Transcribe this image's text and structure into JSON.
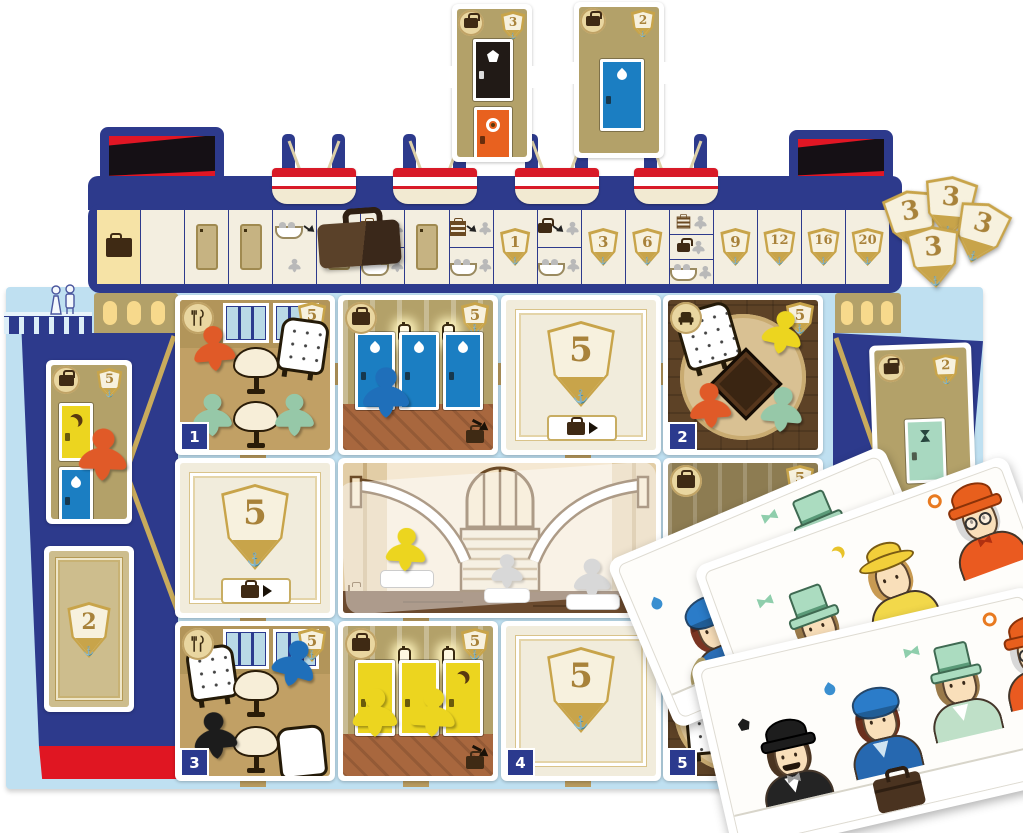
{
  "top_corridor_tiles": [
    {
      "shield": "3",
      "doors": [
        "black-pentagon",
        "orange-ring"
      ]
    },
    {
      "shield": "2",
      "doors": [
        "blue-drop"
      ]
    }
  ],
  "score_track": {
    "shields": [
      "1",
      "3",
      "6",
      "9",
      "12",
      "16",
      "20"
    ],
    "squares": [
      "start-suitcase",
      "blank",
      "door",
      "door",
      "boat-meeple",
      "door-with-suitcase-piece",
      "split-stack-boat",
      "door",
      "split-stack-boat",
      "shield-1",
      "split-suitcase-boat",
      "shield-3",
      "shield-6",
      "split-stack-suitcase-boat",
      "shield-9",
      "shield-12",
      "shield-16",
      "shield-20"
    ]
  },
  "victory_tokens": {
    "value": "3",
    "count": 4
  },
  "side_tiles": {
    "left_cabin_shield": "5",
    "left_score_value": "2",
    "right_cabin_shield": "2"
  },
  "grid_tiles": {
    "dining1": {
      "badge": "1",
      "shield": "5"
    },
    "cabin_blue": {
      "shield": "5"
    },
    "score_a": {
      "value": "5"
    },
    "lounge2": {
      "badge": "2",
      "shield": "5"
    },
    "score_b": {
      "value": "5"
    },
    "cabin_dark": {
      "shield": "5"
    },
    "dining3": {
      "badge": "3",
      "shield": "5"
    },
    "cabin_yellow": {
      "shield": "5"
    },
    "score_c": {
      "value": "5",
      "badge": "4"
    },
    "lounge5": {
      "badge": "5"
    }
  },
  "cards": [
    {
      "characters": [
        {
          "hat": "blue-cloche",
          "icon": "drop"
        },
        {
          "hat": "green-tophat",
          "icon": "bow"
        }
      ],
      "extra": "turn-arrow"
    },
    {
      "characters": [
        {
          "hat": "green-tophat",
          "icon": "bow"
        },
        {
          "hat": "yellow-sun",
          "icon": "moon"
        },
        {
          "hat": "orange-bowler",
          "icon": "ring"
        }
      ]
    },
    {
      "characters": [
        {
          "hat": "black-bowler",
          "icon": "pentagon"
        },
        {
          "hat": "blue-cloche",
          "icon": "drop"
        },
        {
          "hat": "green-tophat",
          "icon": "bow"
        },
        {
          "hat": "orange-bowler",
          "icon": "ring"
        }
      ],
      "extra": "suitcase"
    }
  ],
  "colors": {
    "navy": "#2d3a8c",
    "red": "#e01624",
    "light_blue": "#bfe0f1",
    "gold": "#c8a44a",
    "tan": "#b3a169"
  }
}
